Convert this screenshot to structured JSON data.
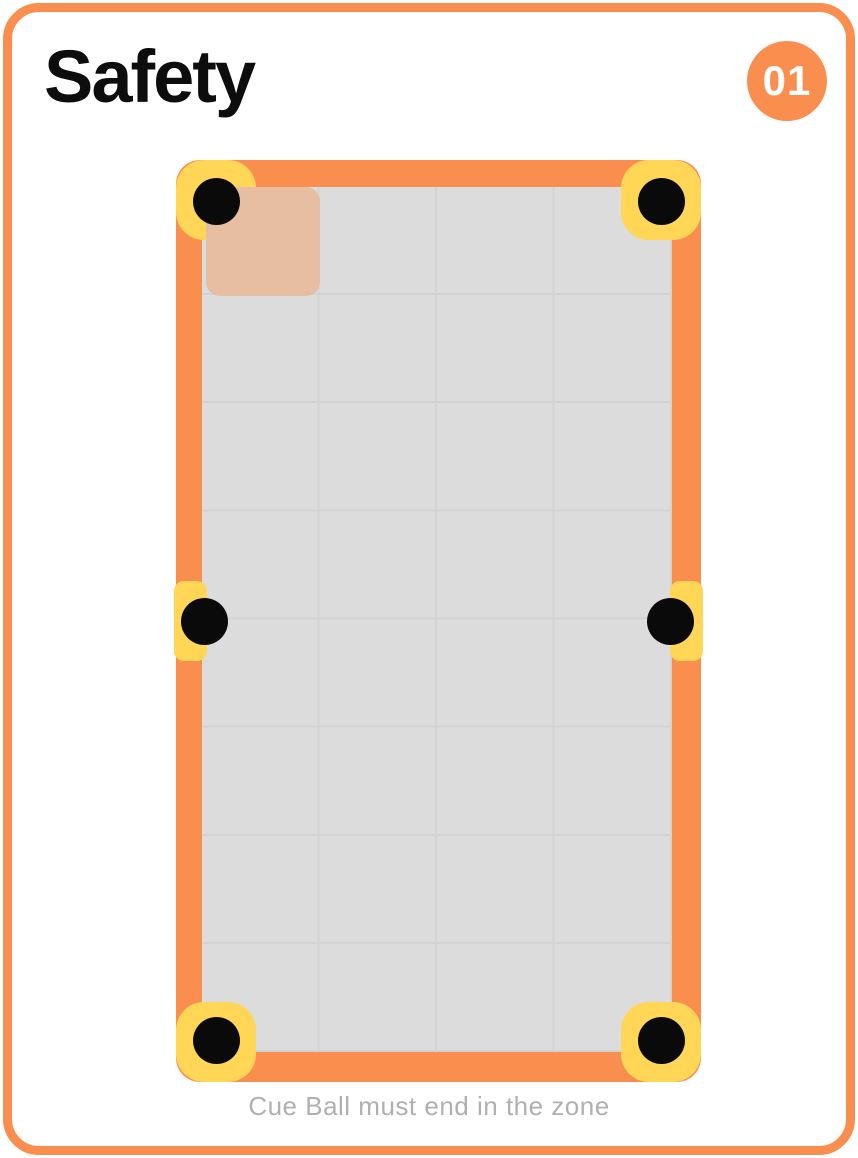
{
  "card": {
    "title": "Safety",
    "badge": "01",
    "caption": "Cue Ball must end in the zone"
  },
  "colors": {
    "accent_orange": "#FA8E4F",
    "pocket_yellow": "#FFD655",
    "pocket_black": "#0A0A0A",
    "felt_gray": "#DCDCDC",
    "gridline_gray": "#D3D3D3",
    "zone_peach": "#E8BEA3",
    "caption_gray": "#B0B0B0",
    "title_black": "#0D0D0D",
    "badge_text": "#FFFFFF"
  },
  "table": {
    "grid": {
      "columns": 4,
      "rows": 8
    },
    "zone": {
      "row": 1,
      "column": 1,
      "meaning": "target zone for cue ball"
    },
    "pockets": {
      "count": 6,
      "positions": [
        "top-left",
        "top-right",
        "middle-left",
        "middle-right",
        "bottom-left",
        "bottom-right"
      ]
    }
  }
}
